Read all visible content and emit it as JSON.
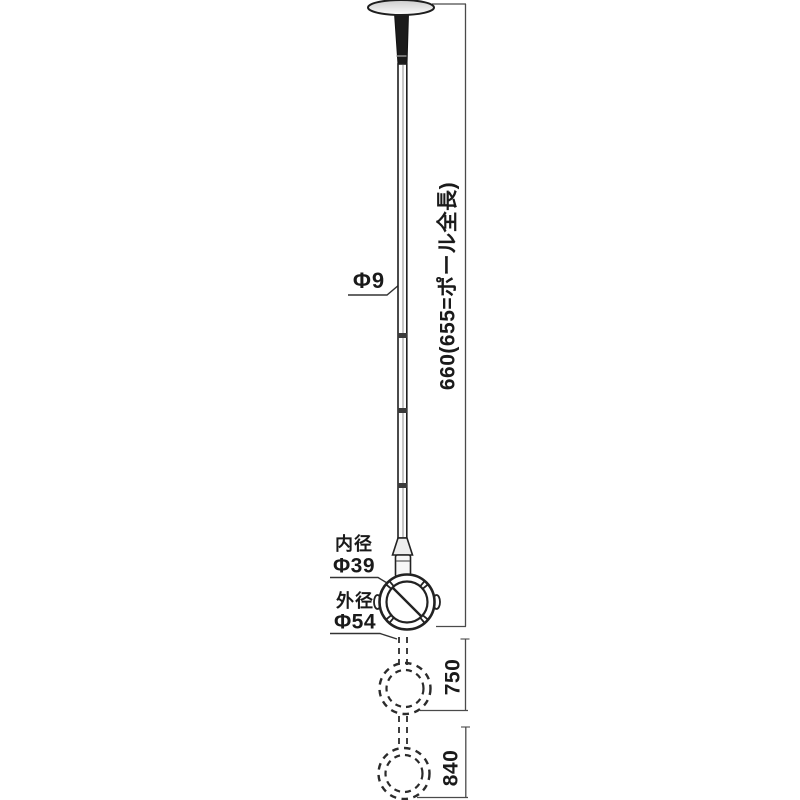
{
  "drawing": {
    "part_labels": {
      "pole_diameter": "Φ9",
      "ring_inner": {
        "label": "内径",
        "value": "Φ39"
      },
      "ring_outer": {
        "label": "外径",
        "value": "Φ54"
      }
    },
    "dimensions": {
      "total": "660(655=ポール全長)",
      "extended_mid": "750",
      "extended_max": "840"
    },
    "colors": {
      "line": "#2b2b2b",
      "dimension_line": "#4a4a4a",
      "text": "#1a1a1a",
      "background": "#ffffff"
    }
  }
}
